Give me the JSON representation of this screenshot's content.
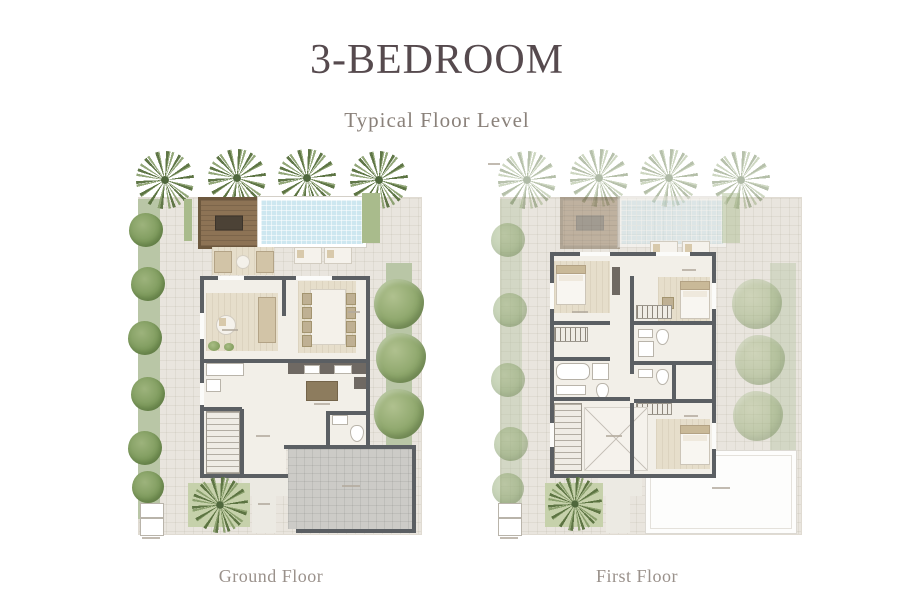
{
  "header": {
    "title": "3-BEDROOM",
    "subtitle": "Typical Floor Level"
  },
  "plans": [
    {
      "id": "ground-floor",
      "caption": "Ground Floor"
    },
    {
      "id": "first-floor",
      "caption": "First Floor"
    }
  ],
  "palette": {
    "title_text": "#564a4e",
    "subtitle_text": "#8a817a",
    "caption_text": "#9a918b",
    "plot_paving": "#e9e5de",
    "greenery": "#b9c6a6",
    "greenery_faded": "#d6dec9",
    "pool_water": "#cde7f0",
    "sun_deck": "#8d7355",
    "walls": "#5b5f63",
    "interior_floor": "#f2efe8",
    "garage_floor": "#cccbc7",
    "roof": "#fdfdfc"
  }
}
